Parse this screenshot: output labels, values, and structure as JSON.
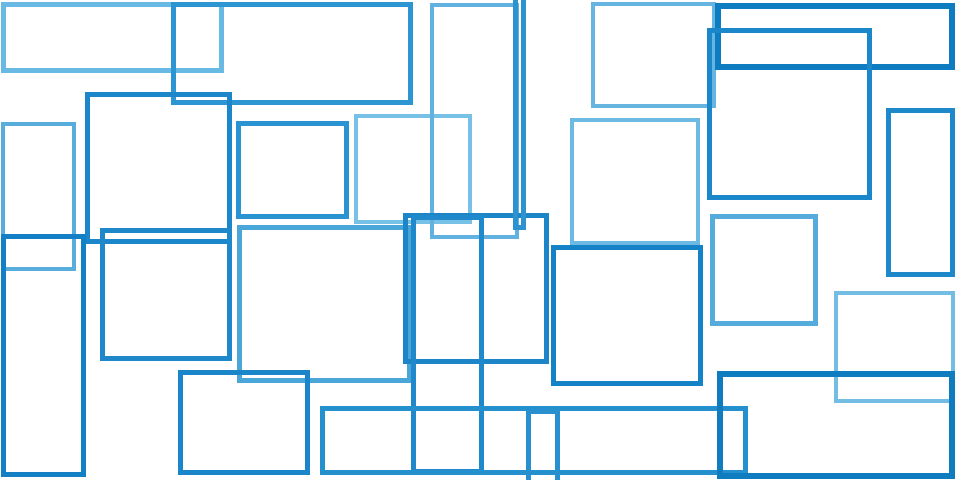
{
  "canvas": {
    "kind": "abstract-geometric-illustration",
    "description": "Overlapping blue rectangle outlines on a white background",
    "width_px": 960,
    "height_px": 480,
    "background_color": "#ffffff",
    "palette": {
      "light_blue": "#6FBCE5",
      "medium_light_blue": "#54ABDB",
      "medium_blue": "#2A93D2",
      "dark_blue": "#1B86C9",
      "deep_blue": "#0E7CC1"
    },
    "rectangles": [
      {
        "id": "top-left-wide",
        "x": 1,
        "y": 2,
        "w": 223,
        "h": 71,
        "stroke": "#68B9E4",
        "weight": 5
      },
      {
        "id": "top-band-medium",
        "x": 171,
        "y": 2,
        "w": 242,
        "h": 103,
        "stroke": "#2E95D3",
        "weight": 5
      },
      {
        "id": "left-tall-light",
        "x": 1,
        "y": 122,
        "w": 75,
        "h": 149,
        "stroke": "#58ADDC",
        "weight": 4
      },
      {
        "id": "left-square-dark",
        "x": 85,
        "y": 92,
        "w": 147,
        "h": 152,
        "stroke": "#1B86C9",
        "weight": 5
      },
      {
        "id": "left-tall-dark",
        "x": 1,
        "y": 234,
        "w": 85,
        "h": 243,
        "stroke": "#1380C5",
        "weight": 5
      },
      {
        "id": "left-mid-square",
        "x": 100,
        "y": 228,
        "w": 132,
        "h": 133,
        "stroke": "#1E88CA",
        "weight": 5
      },
      {
        "id": "center-small-square",
        "x": 236,
        "y": 121,
        "w": 113,
        "h": 98,
        "stroke": "#2A93D2",
        "weight": 5
      },
      {
        "id": "center-light-square",
        "x": 354,
        "y": 114,
        "w": 118,
        "h": 110,
        "stroke": "#77C0E6",
        "weight": 4
      },
      {
        "id": "center-big-light",
        "x": 237,
        "y": 225,
        "w": 175,
        "h": 158,
        "stroke": "#4AA5D9",
        "weight": 5
      },
      {
        "id": "center-tall-light",
        "x": 430,
        "y": 3,
        "w": 89,
        "h": 236,
        "stroke": "#61B2E0",
        "weight": 4
      },
      {
        "id": "center-mid-dark",
        "x": 403,
        "y": 213,
        "w": 146,
        "h": 151,
        "stroke": "#1B85C8",
        "weight": 5
      },
      {
        "id": "center-sliver-tall",
        "x": 513,
        "y": -12,
        "w": 13,
        "h": 242,
        "stroke": "#2C92D0",
        "weight": 5
      },
      {
        "id": "center-narrow-dark",
        "x": 411,
        "y": 215,
        "w": 73,
        "h": 259,
        "stroke": "#1F89CB",
        "weight": 5
      },
      {
        "id": "bottom-left-square",
        "x": 178,
        "y": 370,
        "w": 132,
        "h": 105,
        "stroke": "#1A86C9",
        "weight": 5
      },
      {
        "id": "top-center-light",
        "x": 591,
        "y": 2,
        "w": 125,
        "h": 106,
        "stroke": "#66B5E1",
        "weight": 4
      },
      {
        "id": "mid-center-light",
        "x": 570,
        "y": 118,
        "w": 130,
        "h": 127,
        "stroke": "#6CB9E3",
        "weight": 4
      },
      {
        "id": "center-dark-square",
        "x": 551,
        "y": 245,
        "w": 152,
        "h": 141,
        "stroke": "#1482C6",
        "weight": 5
      },
      {
        "id": "bottom-long-bar",
        "x": 320,
        "y": 406,
        "w": 428,
        "h": 69,
        "stroke": "#2590CE",
        "weight": 5
      },
      {
        "id": "bottom-narrow-column",
        "x": 526,
        "y": 409,
        "w": 34,
        "h": 86,
        "stroke": "#2890CE",
        "weight": 5
      },
      {
        "id": "top-right-wide-deep",
        "x": 715,
        "y": 3,
        "w": 240,
        "h": 67,
        "stroke": "#0E7CC1",
        "weight": 6
      },
      {
        "id": "right-big-dark",
        "x": 707,
        "y": 28,
        "w": 165,
        "h": 172,
        "stroke": "#1987CA",
        "weight": 5
      },
      {
        "id": "right-tall-narrow",
        "x": 886,
        "y": 108,
        "w": 69,
        "h": 169,
        "stroke": "#1D89CB",
        "weight": 5
      },
      {
        "id": "right-mid-light",
        "x": 710,
        "y": 214,
        "w": 108,
        "h": 112,
        "stroke": "#55ACDC",
        "weight": 5
      },
      {
        "id": "right-light-square",
        "x": 834,
        "y": 291,
        "w": 121,
        "h": 112,
        "stroke": "#73BDE5",
        "weight": 4
      },
      {
        "id": "bottom-right-deep",
        "x": 717,
        "y": 371,
        "w": 238,
        "h": 108,
        "stroke": "#0F7CC0",
        "weight": 6
      }
    ]
  }
}
